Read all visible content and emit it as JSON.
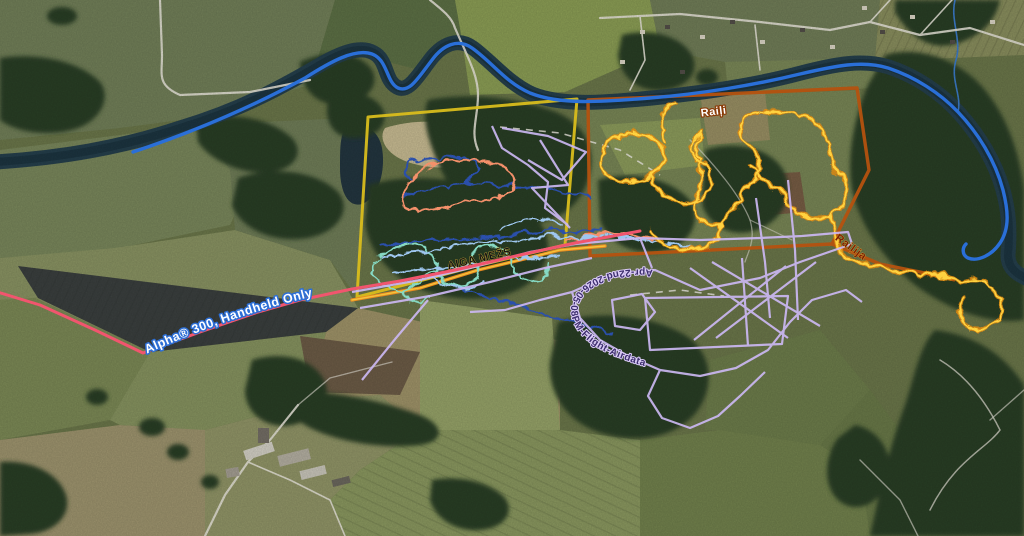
{
  "map": {
    "description": "Aerial satellite basemap with overlaid GPS tracks and area boundaries",
    "labels": {
      "alpha_track": "Alpha® 300, Handheld Only",
      "aiga_mezs": "AIGA MEŽS",
      "raili": "Raiļi",
      "railija": "Raiļija",
      "flight_log": "Apr-22nd-2026-05-08PM-Flight-Airdata"
    },
    "tracks": [
      {
        "id": "alpha-handheld",
        "label": "Alpha® 300, Handheld Only",
        "color": "#f1556e"
      },
      {
        "id": "river-route",
        "label": "",
        "color": "#2a6fd8"
      },
      {
        "id": "west-boundary",
        "label": "",
        "color": "#d9bd1c"
      },
      {
        "id": "raili-boundary",
        "label": "Raiļi",
        "color": "#b5520f"
      },
      {
        "id": "railija-walk",
        "label": "Raiļija",
        "color": "#ffd23f"
      },
      {
        "id": "aiga-mezs-route",
        "label": "AIGA MEŽS",
        "color": "#ea8a1f"
      },
      {
        "id": "drone-flight-log",
        "label": "Apr-22nd-2026-05-08PM-Flight-Airdata",
        "color": "#cbb7f2"
      },
      {
        "id": "teal-loops",
        "label": "",
        "color": "#86d9c3"
      },
      {
        "id": "skyblue-loops",
        "label": "",
        "color": "#9ec6ef"
      },
      {
        "id": "navy-loops",
        "label": "",
        "color": "#2c50ab"
      },
      {
        "id": "coral-loop",
        "label": "",
        "color": "#f4906b"
      }
    ],
    "label_colors": {
      "alpha_text": "#ffffff",
      "alpha_halo": "#2d6fd6",
      "aiga_text": "#161616",
      "raili_text": "#ffffff",
      "raili_halo": "#8a3c08",
      "railija_text": "#7c1f04",
      "flight_text": "#3d2f6e",
      "flight_halo": "#dccdf8"
    }
  }
}
